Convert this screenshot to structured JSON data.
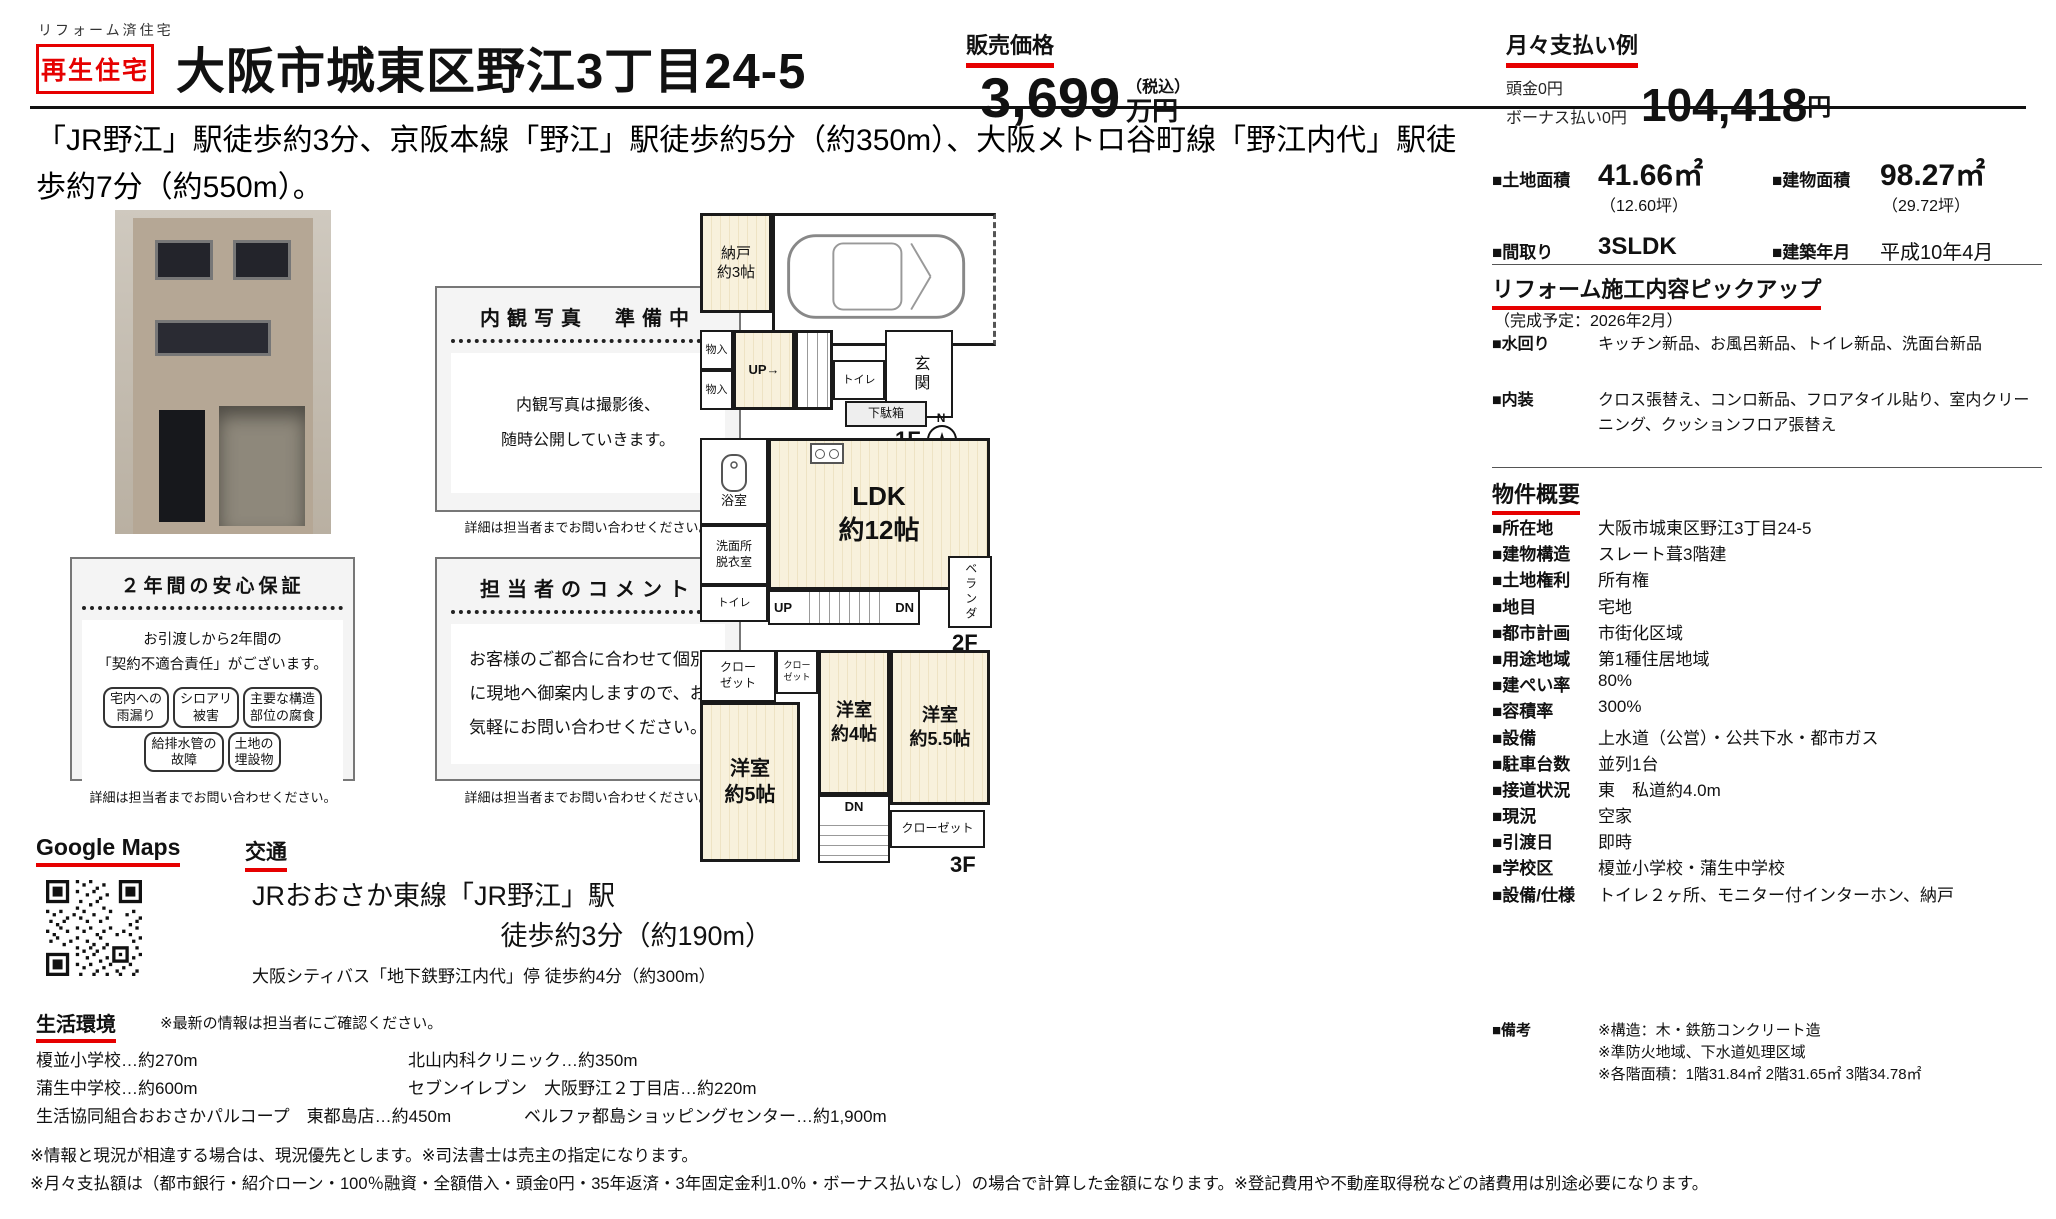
{
  "colors": {
    "accent_red": "#e60000",
    "tatami_fill": "#f8f1dc"
  },
  "header": {
    "small_label": "リフォーム済住宅",
    "badge": "再生住宅",
    "title": "大阪市城東区野江3丁目24-5",
    "price_label": "販売価格",
    "price_value": "3,699",
    "price_unit": "万円",
    "price_tax_note": "（税込）",
    "monthly_label": "月々支払い例",
    "monthly_down": "頭金0円",
    "monthly_bonus": "ボーナス払い0円",
    "monthly_value": "104,418",
    "monthly_unit": "円"
  },
  "description": "「JR野江」駅徒歩約3分、京阪本線「野江」駅徒歩約5分（約350m）、大阪メトロ谷町線「野江内代」駅徒歩約7分（約550m）。",
  "specs": {
    "land_label": "■土地面積",
    "land_value": "41.66㎡",
    "land_sub": "（12.60坪）",
    "building_label": "■建物面積",
    "building_value": "98.27㎡",
    "building_sub": "（29.72坪）",
    "madori_label": "■間取り",
    "madori_value": "3SLDK",
    "built_label": "■建築年月",
    "built_value": "平成10年4月"
  },
  "renovation": {
    "title": "リフォーム施工内容ピックアップ",
    "completion": "（完成予定：2026年2月）",
    "rows": [
      {
        "label": "■水回り",
        "value": "キッチン新品、お風呂新品、トイレ新品、洗面台新品"
      },
      {
        "label": "■内装",
        "value": "クロス張替え、コンロ新品、フロアタイル貼り、室内クリーニング、クッションフロア張替え"
      }
    ]
  },
  "overview": {
    "title": "物件概要",
    "rows": [
      {
        "label": "■所在地",
        "value": "大阪市城東区野江3丁目24-5"
      },
      {
        "label": "■建物構造",
        "value": "スレート葺3階建"
      },
      {
        "label": "■土地権利",
        "value": "所有権"
      },
      {
        "label": "■地目",
        "value": "宅地"
      },
      {
        "label": "■都市計画",
        "value": "市街化区域"
      },
      {
        "label": "■用途地域",
        "value": "第1種住居地域"
      },
      {
        "label": "■建ぺい率",
        "value": "80%"
      },
      {
        "label": "■容積率",
        "value": "300%"
      },
      {
        "label": "■設備",
        "value": "上水道（公営）・公共下水・都市ガス"
      },
      {
        "label": "■駐車台数",
        "value": "並列1台"
      },
      {
        "label": "■接道状況",
        "value": "東　私道約4.0m"
      },
      {
        "label": "■現況",
        "value": "空家"
      },
      {
        "label": "■引渡日",
        "value": "即時"
      },
      {
        "label": "■学校区",
        "value": "榎並小学校・蒲生中学校"
      },
      {
        "label": "■設備/仕様",
        "value": "トイレ２ヶ所、モニター付インターホン、納戸"
      }
    ],
    "remarks_label": "■備考",
    "remarks": "※構造：木・鉄筋コンクリート造\n※準防火地域、下水道処理区域\n※各階面積：1階31.84㎡ 2階31.65㎡ 3階34.78㎡"
  },
  "interior_box": {
    "title": "内観写真　準備中",
    "body": "内観写真は撮影後、\n随時公開していきます。"
  },
  "warranty_box": {
    "title": "２年間の安心保証",
    "body": "お引渡しから2年間の\n「契約不適合責任」がございます。",
    "pills": [
      "宅内への\n雨漏り",
      "シロアリ\n被害",
      "主要な構造\n部位の腐食",
      "給排水管の\n故障",
      "土地の\n埋設物"
    ]
  },
  "comment_box": {
    "title": "担当者のコメント",
    "body": "お客様のご都合に合わせて個別\nに現地へ御案内しますので、お\n気軽にお問い合わせください。"
  },
  "caption_note": "詳細は担当者までお問い合わせください。",
  "maps_title": "Google Maps",
  "access": {
    "title": "交通",
    "line1": "JRおおさか東線「JR野江」駅",
    "line2": "徒歩約3分（約190m）",
    "line3": "大阪シティバス「地下鉄野江内代」停 徒歩約4分（約300m）"
  },
  "environment": {
    "title": "生活環境",
    "note": "※最新の情報は担当者にご確認ください。",
    "rows": [
      {
        "left": "榎並小学校…約270m",
        "right": "北山内科クリニック…約350m"
      },
      {
        "left": "蒲生中学校…約600m",
        "right": "セブンイレブン　大阪野江２丁目店…約220m"
      },
      {
        "left": "生活協同組合おおさかパルコープ　東都島店…約450m",
        "right": "ベルファ都島ショッピングセンター…約1,900m"
      }
    ]
  },
  "disclaimers": [
    "※情報と現況が相違する場合は、現況優先とします。※司法書士は売主の指定になります。",
    "※月々支払額は（都市銀行・紹介ローン・100％融資・全額借入・頭金0円・35年返済・3年固定金利1.0％・ボーナス払いなし）の場合で計算した金額になります。※登記費用や不動産取得税などの諸費用は別途必要になります。"
  ],
  "floorplan": {
    "f1": {
      "label": "1F",
      "compass": "N",
      "nando": "納戸\n約3帖",
      "mono1": "物入",
      "mono2": "物入",
      "up": "UP→",
      "toilet": "トイレ",
      "genkan": "玄関",
      "getabako": "下駄箱"
    },
    "f2": {
      "label": "2F",
      "bath": "浴室",
      "senmen": "洗面所\n脱衣室",
      "toilet": "トイレ",
      "ldk": "LDK\n約12帖",
      "up": "UP",
      "dn": "DN",
      "veranda": "ベランダ"
    },
    "f3": {
      "label": "3F",
      "closet_a": "クロー\nゼット",
      "closet_b": "クロー\nゼット",
      "room_5": "洋室\n約5帖",
      "room_4": "洋室\n約4帖",
      "room_55": "洋室\n約5.5帖",
      "dn": "DN",
      "closet_c": "クローゼット"
    }
  }
}
